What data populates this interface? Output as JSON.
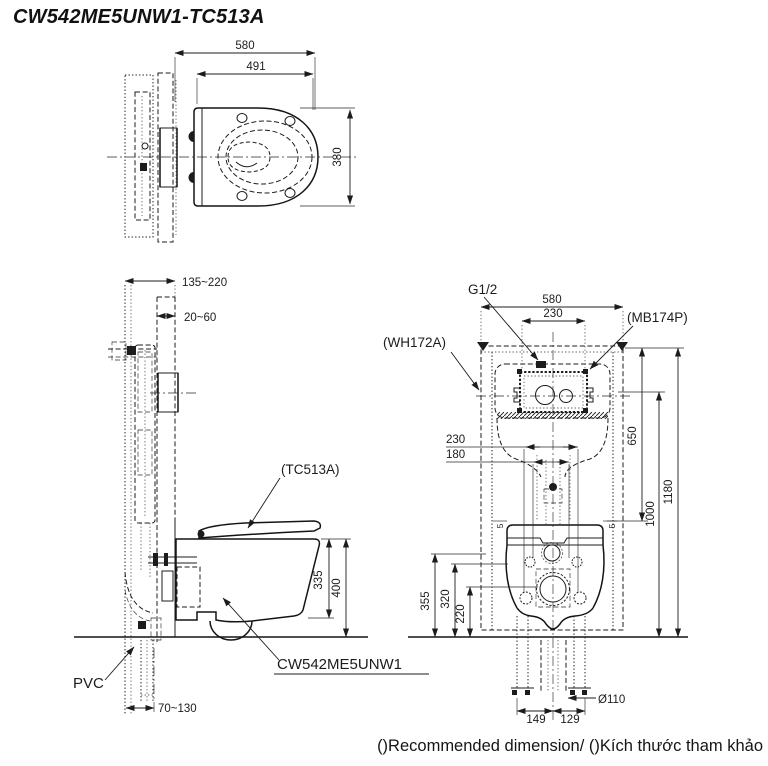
{
  "title": "CW542ME5UNW1-TC513A",
  "footer": "()Recommended dimension/ ()Kích thước tham khảo",
  "top_view": {
    "overall_depth": "580",
    "seat_length": "491",
    "bowl_width": "380"
  },
  "side_view": {
    "wall_cavity": "135~220",
    "wall_finish": "20~60",
    "seat_label": "(TC513A)",
    "rim_to_bottom": "335",
    "rim_to_floor": "400",
    "bowl_label": "CW542ME5UNW1",
    "pipe_label": "PVC",
    "drain_offset": "70~130"
  },
  "front_view": {
    "supply_label": "G1/2",
    "frame_width": "580",
    "plate_width": "230",
    "plate_label": "(MB174P)",
    "frame_label": "(WH172A)",
    "holes_outer": "230",
    "holes_inner": "180",
    "frame_to_seat": "650",
    "plate_height": "1000",
    "frame_height": "1180",
    "h_supply": "355",
    "h_bolts": "320",
    "h_drain": "220",
    "gap_left": "5",
    "gap_right": "5",
    "drain_dia": "Ø110",
    "leg_left": "149",
    "leg_right": "129"
  }
}
